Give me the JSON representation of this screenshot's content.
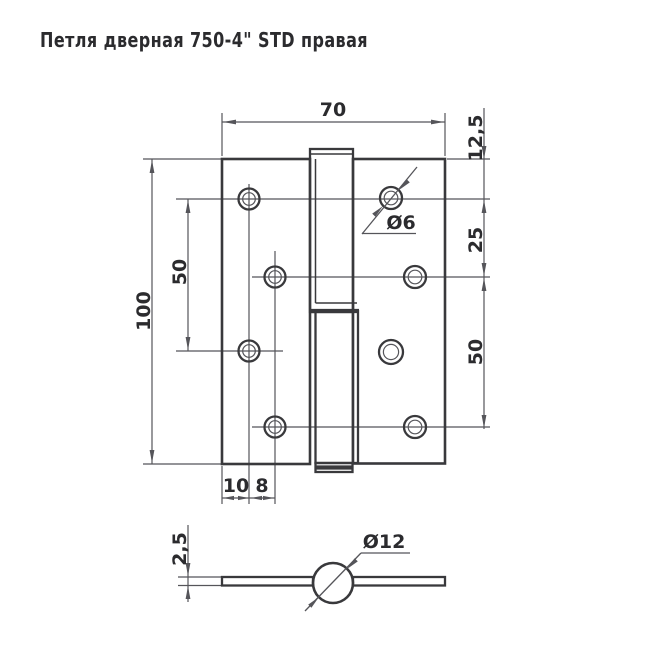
{
  "title": "Петля  дверная 750-4\" STD правая",
  "colors": {
    "background": "#ffffff",
    "outline": "#39393c",
    "thin_line": "#55555a",
    "text_color": "#2b2b2e"
  },
  "front_view": {
    "dimensions": {
      "width": "70",
      "top_edge_to_hole": "12,5",
      "upper_hole_pitch": "25",
      "right_hole_pitch": "50",
      "height": "100",
      "left_hole_pitch": "50",
      "edge_to_hole_column": "10",
      "hole_column_step": "8",
      "screw_hole_diameter": "Ø6"
    }
  },
  "side_view": {
    "dimensions": {
      "leaf_thickness": "2,5",
      "knuckle_diameter": "Ø12"
    }
  }
}
